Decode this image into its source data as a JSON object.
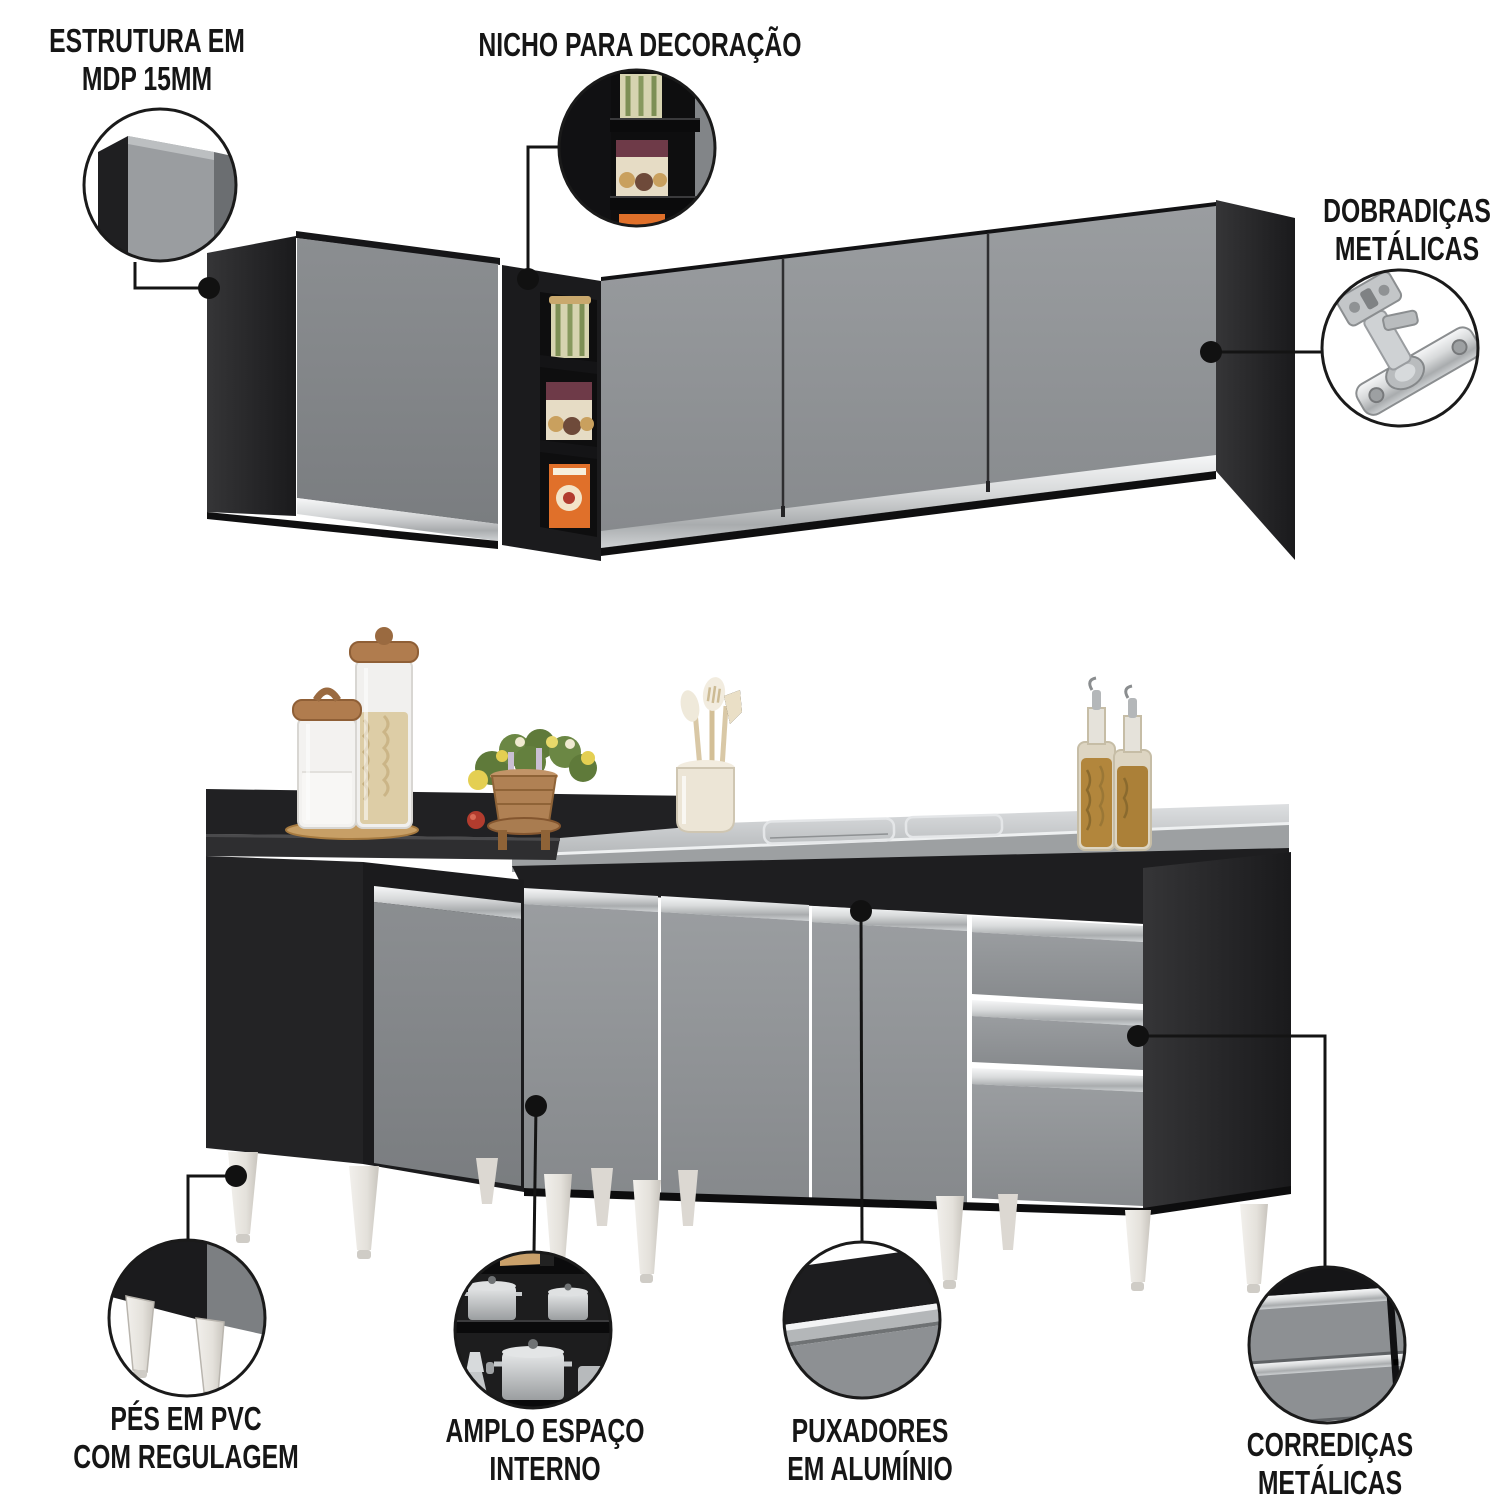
{
  "meta": {
    "kind": "product-feature-infographic",
    "subject": "L-shaped kitchen cabinet set (wall cabinets with decorative niche + base cabinets with sink countertop)",
    "language": "pt-BR"
  },
  "callouts": {
    "estrutura": {
      "line1": "ESTRUTURA EM",
      "line2": "MDP 15MM"
    },
    "nicho": {
      "line1": "NICHO PARA DECORAÇÃO",
      "line2": ""
    },
    "dobradicas": {
      "line1": "DOBRADIÇAS",
      "line2": "METÁLICAS"
    },
    "pes": {
      "line1": "PÉS EM PVC",
      "line2": "COM REGULAGEM"
    },
    "amplo": {
      "line1": "AMPLO ESPAÇO",
      "line2": "INTERNO"
    },
    "puxadores": {
      "line1": "PUXADORES",
      "line2": "EM ALUMÍNIO"
    },
    "corredicas": {
      "line1": "CORREDIÇAS",
      "line2": "METÁLICAS"
    }
  },
  "colors": {
    "background": "#ffffff",
    "label_text": "#161616",
    "connector_line": "#141414",
    "cabinet_black": "#1d1d1f",
    "door_gray": "#8d9093",
    "aluminum_handle": "#c9ccce",
    "countertop_steel": "#c2c5c7",
    "leg_white_pvc": "#e9e6e1",
    "wood_lid": "#b07c4e",
    "niche_box_orange": "#e0702a",
    "niche_box_beige": "#e6dcc5",
    "plant_green": "#5f7a3a",
    "oil_amber": "#b2863c"
  }
}
